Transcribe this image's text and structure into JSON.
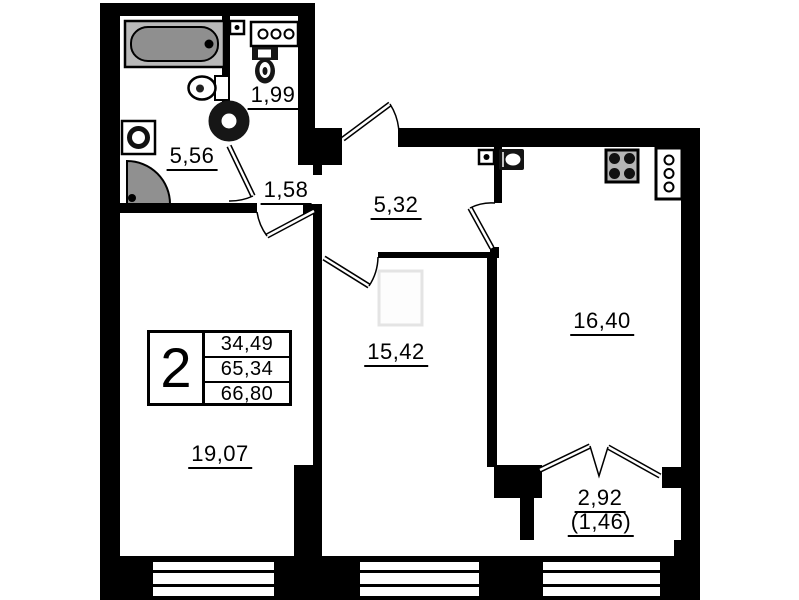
{
  "info_box": {
    "rooms_count": "2",
    "living_area": "34,49",
    "area": "65,34",
    "total_area": "66,80"
  },
  "rooms": {
    "bathroom": "5,56",
    "toilet": "1,99",
    "hall": "1,58",
    "corridor": "5,32",
    "living_room": "19,07",
    "bedroom": "15,42",
    "kitchen": "16,40",
    "balcony": "2,92",
    "balcony_reduced": "(1,46)"
  },
  "colors": {
    "walls": "#000000",
    "background": "#ffffff",
    "fixture_gray": "#909090",
    "stove_gray": "#b5b5b5"
  }
}
